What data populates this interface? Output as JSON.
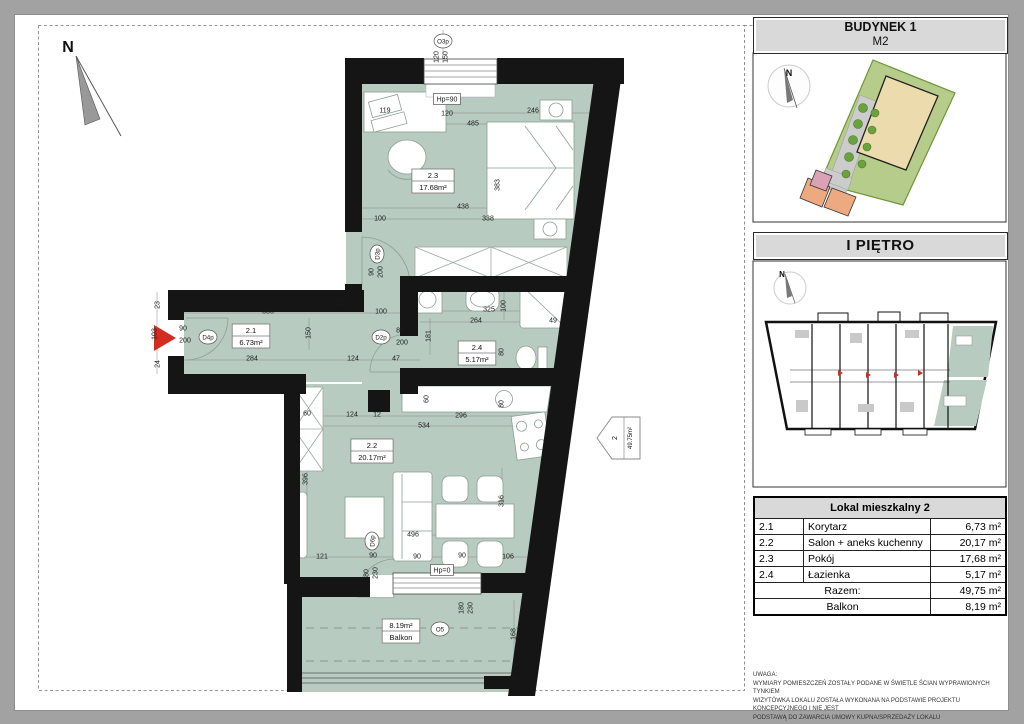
{
  "panel": {
    "building_title": "BUDYNEK 1",
    "building_unit": "M2",
    "floor_title": "I PIĘTRO",
    "table": {
      "title": "Lokal mieszkalny 2",
      "rows": [
        [
          "2.1",
          "Korytarz",
          "6,73 m²"
        ],
        [
          "2.2",
          "Salon + aneks kuchenny",
          "20,17 m²"
        ],
        [
          "2.3",
          "Pokój",
          "17,68 m²"
        ],
        [
          "2.4",
          "Łazienka",
          "5,17 m²"
        ]
      ],
      "summary": [
        [
          "Razem:",
          "49,75 m²"
        ],
        [
          "Balkon",
          "8,19 m²"
        ]
      ]
    },
    "notes": [
      "UWAGA:",
      "WYMIARY POMIESZCZEŃ ZOSTAŁY PODANE W ŚWIETLE ŚCIAN WYPRAWIONYCH TYNKIEM",
      "WIZYTÓWKA LOKALU ZOSTAŁA WYKONANA NA PODSTAWIE PROJEKTU KONCEPCYJNEGO I NIE JEST",
      "PODSTAWĄ DO ZAWARCIA UMOWY KUPNA/SPRZEDAŻY LOKALU"
    ]
  },
  "plan": {
    "unit_marker": {
      "number": "2",
      "area": "49.75m²"
    },
    "compass_labels": [
      {
        "t": "N",
        "x": 68,
        "y": 52,
        "size": 16
      },
      {
        "t": "N",
        "x": 789,
        "y": 76,
        "size": 9
      },
      {
        "t": "N",
        "x": 782,
        "y": 277,
        "size": 8
      }
    ],
    "rooms": [
      {
        "line1": "2.3",
        "line2": "17.68m²",
        "x": 433,
        "y": 181
      },
      {
        "line1": "2.1",
        "line2": "6.73m²",
        "x": 251,
        "y": 336
      },
      {
        "line1": "2.4",
        "line2": "5.17m²",
        "x": 477,
        "y": 353
      },
      {
        "line1": "2.2",
        "line2": "20.17m²",
        "x": 372,
        "y": 451
      },
      {
        "line1": "8.19m²",
        "line2": "Balkon",
        "x": 401,
        "y": 631
      }
    ],
    "annotations": [
      {
        "t": "O3p",
        "x": 443,
        "y": 41,
        "s": "circ"
      },
      {
        "t": "120",
        "x": 436,
        "y": 57,
        "r": 90
      },
      {
        "t": "150",
        "x": 445,
        "y": 57,
        "r": 90
      },
      {
        "t": "Hp=90",
        "x": 447,
        "y": 99,
        "s": "box"
      },
      {
        "t": "120",
        "x": 447,
        "y": 113
      },
      {
        "t": "119",
        "x": 385,
        "y": 110
      },
      {
        "t": "485",
        "x": 473,
        "y": 123
      },
      {
        "t": "246",
        "x": 533,
        "y": 110
      },
      {
        "t": "383",
        "x": 497,
        "y": 185,
        "r": 90
      },
      {
        "t": "438",
        "x": 463,
        "y": 206
      },
      {
        "t": "100",
        "x": 380,
        "y": 218
      },
      {
        "t": "338",
        "x": 488,
        "y": 218
      },
      {
        "t": "D3p",
        "x": 377,
        "y": 254,
        "s": "circ",
        "r": 90
      },
      {
        "t": "90",
        "x": 371,
        "y": 272,
        "r": 90
      },
      {
        "t": "200",
        "x": 380,
        "y": 272,
        "r": 90
      },
      {
        "t": "23",
        "x": 157,
        "y": 305,
        "r": 90
      },
      {
        "t": "103",
        "x": 154,
        "y": 334,
        "r": 90
      },
      {
        "t": "24",
        "x": 157,
        "y": 364,
        "r": 90
      },
      {
        "t": "90",
        "x": 183,
        "y": 328
      },
      {
        "t": "200",
        "x": 185,
        "y": 340
      },
      {
        "t": "D4p",
        "x": 208,
        "y": 337,
        "s": "circ"
      },
      {
        "t": "355",
        "x": 268,
        "y": 311
      },
      {
        "t": "284",
        "x": 252,
        "y": 358
      },
      {
        "t": "150",
        "x": 308,
        "y": 333,
        "r": 90
      },
      {
        "t": "12",
        "x": 340,
        "y": 303,
        "r": 90
      },
      {
        "t": "124",
        "x": 353,
        "y": 358
      },
      {
        "t": "100",
        "x": 381,
        "y": 311
      },
      {
        "t": "47",
        "x": 396,
        "y": 358
      },
      {
        "t": "D2p",
        "x": 381,
        "y": 337,
        "s": "circ"
      },
      {
        "t": "80",
        "x": 400,
        "y": 330
      },
      {
        "t": "200",
        "x": 402,
        "y": 342
      },
      {
        "t": "325",
        "x": 489,
        "y": 309
      },
      {
        "t": "100",
        "x": 503,
        "y": 306,
        "r": 90
      },
      {
        "t": "264",
        "x": 476,
        "y": 320
      },
      {
        "t": "49",
        "x": 553,
        "y": 320
      },
      {
        "t": "181",
        "x": 428,
        "y": 336,
        "r": 90
      },
      {
        "t": "80",
        "x": 501,
        "y": 352,
        "r": 90
      },
      {
        "t": "60",
        "x": 307,
        "y": 413
      },
      {
        "t": "124",
        "x": 352,
        "y": 414
      },
      {
        "t": "12",
        "x": 377,
        "y": 414
      },
      {
        "t": "296",
        "x": 461,
        "y": 415
      },
      {
        "t": "534",
        "x": 424,
        "y": 425
      },
      {
        "t": "60",
        "x": 426,
        "y": 399,
        "r": 90
      },
      {
        "t": "80",
        "x": 501,
        "y": 404,
        "r": 90
      },
      {
        "t": "396",
        "x": 305,
        "y": 479,
        "r": 90
      },
      {
        "t": "316",
        "x": 501,
        "y": 501,
        "r": 90
      },
      {
        "t": "496",
        "x": 413,
        "y": 534
      },
      {
        "t": "121",
        "x": 322,
        "y": 556
      },
      {
        "t": "90",
        "x": 373,
        "y": 555
      },
      {
        "t": "90",
        "x": 417,
        "y": 556
      },
      {
        "t": "90",
        "x": 462,
        "y": 555
      },
      {
        "t": "106",
        "x": 508,
        "y": 556
      },
      {
        "t": "D6p",
        "x": 372,
        "y": 541,
        "s": "circ",
        "r": 90
      },
      {
        "t": "80",
        "x": 366,
        "y": 573,
        "r": 90
      },
      {
        "t": "230",
        "x": 375,
        "y": 573,
        "r": 90
      },
      {
        "t": "Hp=0",
        "x": 442,
        "y": 570,
        "s": "box"
      },
      {
        "t": "180",
        "x": 461,
        "y": 608,
        "r": 90
      },
      {
        "t": "230",
        "x": 470,
        "y": 608,
        "r": 90
      },
      {
        "t": "O5",
        "x": 440,
        "y": 629,
        "s": "circ"
      },
      {
        "t": "168",
        "x": 513,
        "y": 634,
        "r": 90
      },
      {
        "t": "12",
        "x": 513,
        "y": 678,
        "r": 90
      }
    ]
  },
  "colors": {
    "floor_green": "#b7cbc0",
    "wall_black": "#151515",
    "accent_red": "#d42d1f",
    "site_green": "#b5cc8b",
    "building_beige": "#ecdcad",
    "header_gray": "#d9d9d9"
  }
}
